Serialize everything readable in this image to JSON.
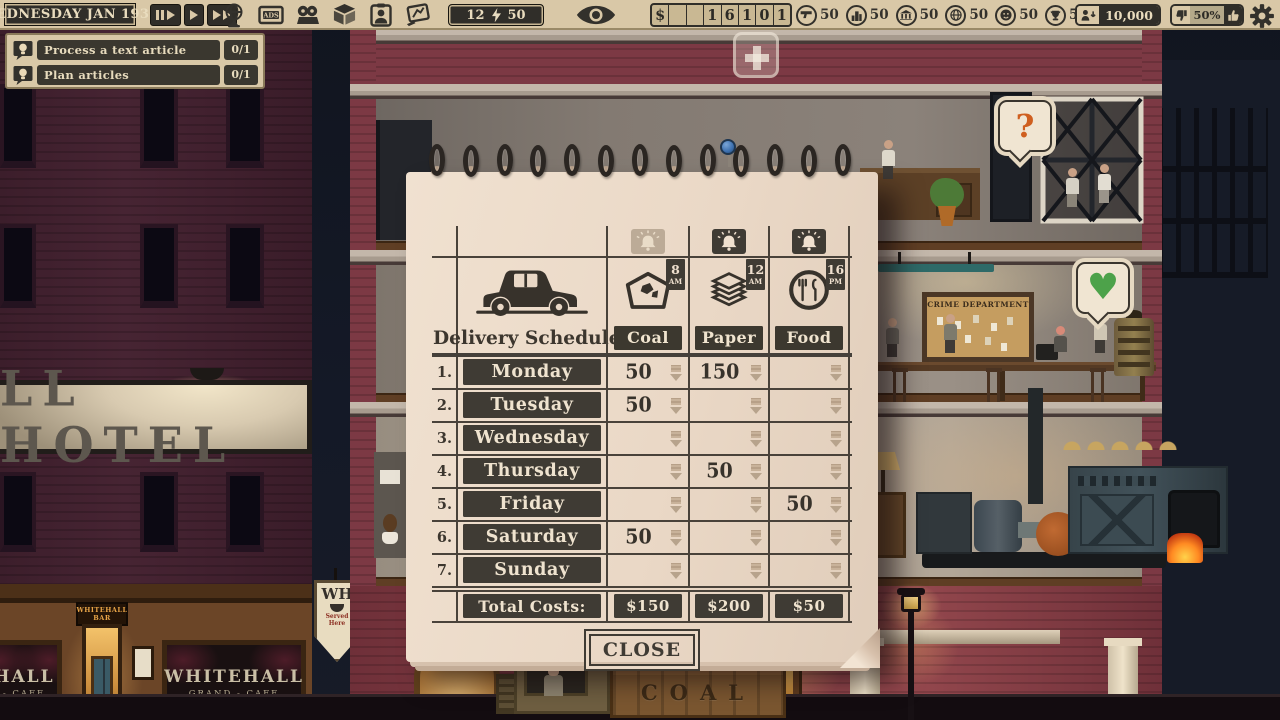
{
  "colors": {
    "top_bar_bg": "#d9c8a7",
    "dark_box": "#36332d",
    "paper": "#ecdccb",
    "ink": "#3f3a33",
    "brick": "#7c3944",
    "sky": "#131826",
    "heart_green": "#4da24a",
    "question_orange": "#cf5f1f",
    "pushpin_blue": "#3c6fae"
  },
  "top_bar": {
    "date": "WEDNESDAY JAN 1930",
    "energy": {
      "left": "12",
      "right": "50"
    },
    "money_cells": [
      "$",
      "",
      "",
      "1",
      "6",
      "1",
      "0",
      "1"
    ],
    "stats": [
      {
        "icon": "gun",
        "value": "50"
      },
      {
        "icon": "building",
        "value": "50"
      },
      {
        "icon": "bank",
        "value": "50"
      },
      {
        "icon": "world",
        "value": "50"
      },
      {
        "icon": "face",
        "value": "50"
      },
      {
        "icon": "trophy",
        "value": "50"
      }
    ],
    "readers": "10,000",
    "approval": "50%"
  },
  "quests": [
    {
      "label": "Process a text article",
      "progress": "0/1"
    },
    {
      "label": "Plan articles",
      "progress": "0/1"
    }
  ],
  "scheduler": {
    "title": "Delivery Scheduler",
    "columns": [
      {
        "name": "Coal",
        "time": "8",
        "meridiem": "AM",
        "bell_active": false
      },
      {
        "name": "Paper",
        "time": "12",
        "meridiem": "AM",
        "bell_active": true
      },
      {
        "name": "Food",
        "time": "16",
        "meridiem": "PM",
        "bell_active": true
      }
    ],
    "rows": [
      {
        "num": "1.",
        "day": "Monday",
        "values": [
          "50",
          "150",
          ""
        ]
      },
      {
        "num": "2.",
        "day": "Tuesday",
        "values": [
          "50",
          "",
          ""
        ]
      },
      {
        "num": "3.",
        "day": "Wednesday",
        "values": [
          "",
          "",
          ""
        ]
      },
      {
        "num": "4.",
        "day": "Thursday",
        "values": [
          "",
          "50",
          ""
        ]
      },
      {
        "num": "5.",
        "day": "Friday",
        "values": [
          "",
          "",
          "50"
        ]
      },
      {
        "num": "6.",
        "day": "Saturday",
        "values": [
          "50",
          "",
          ""
        ]
      },
      {
        "num": "7.",
        "day": "Sunday",
        "values": [
          "",
          "",
          ""
        ]
      }
    ],
    "totals_label": "Total Costs:",
    "totals": [
      "$150",
      "$200",
      "$50"
    ],
    "close_label": "CLOSE"
  },
  "scene": {
    "hotel_sign": "LL HOTEL",
    "cafe_window_name": "WHITEHALL",
    "cafe_window_sub": "GRAND - CAFE",
    "cafe_window_partial_name": "HALL",
    "cafe_window_partial_sub": "- CAFE",
    "cafe_door_sign": "WHITEHALL BAR",
    "arrow_sign_top": "WH",
    "arrow_sign_bottom": "Served Here",
    "crime_board_title": "CRIME DEPARTMENT",
    "truck_label": "COAL",
    "question_bubble": "?",
    "heart_symbol": "♥"
  }
}
